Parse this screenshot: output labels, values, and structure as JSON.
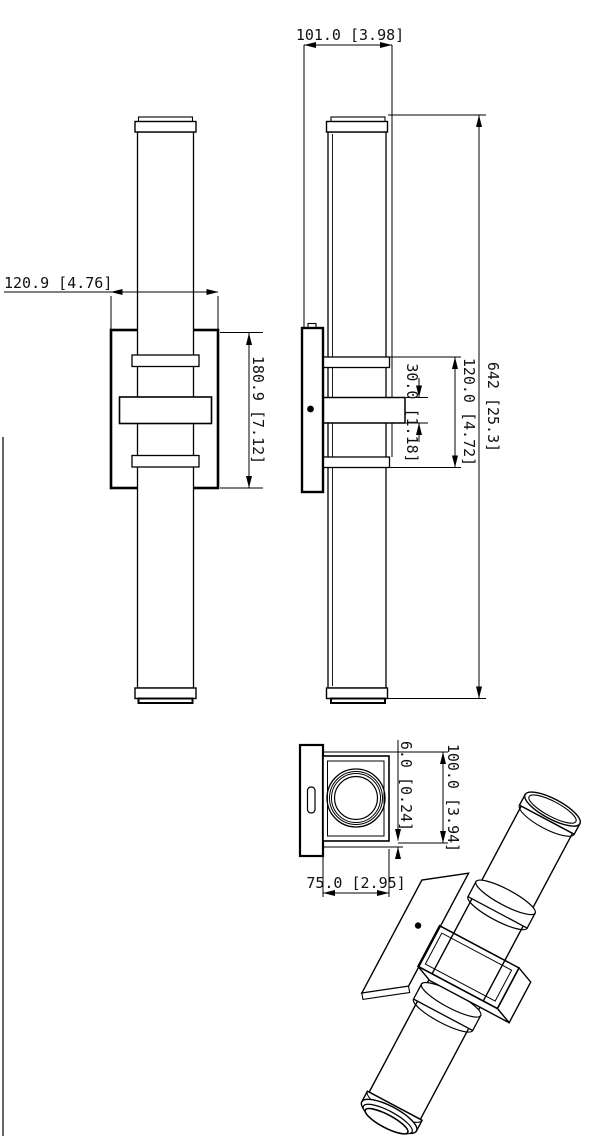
{
  "drawing": {
    "background": "#ffffff",
    "line_color": "#000000",
    "dimensions": {
      "overall_depth": "101.0 [3.98]",
      "plate_width": "120.9 [4.76]",
      "plate_height": "180.9 [7.12]",
      "arm_thickness": "30.0 [1.18]",
      "collar_span": "120.0 [4.72]",
      "overall_height": "642 [25.3]",
      "lip_offset": "6.0 [0.24]",
      "housing_width": "100.0 [3.94]",
      "housing_depth": "75.0 [2.95]"
    }
  }
}
